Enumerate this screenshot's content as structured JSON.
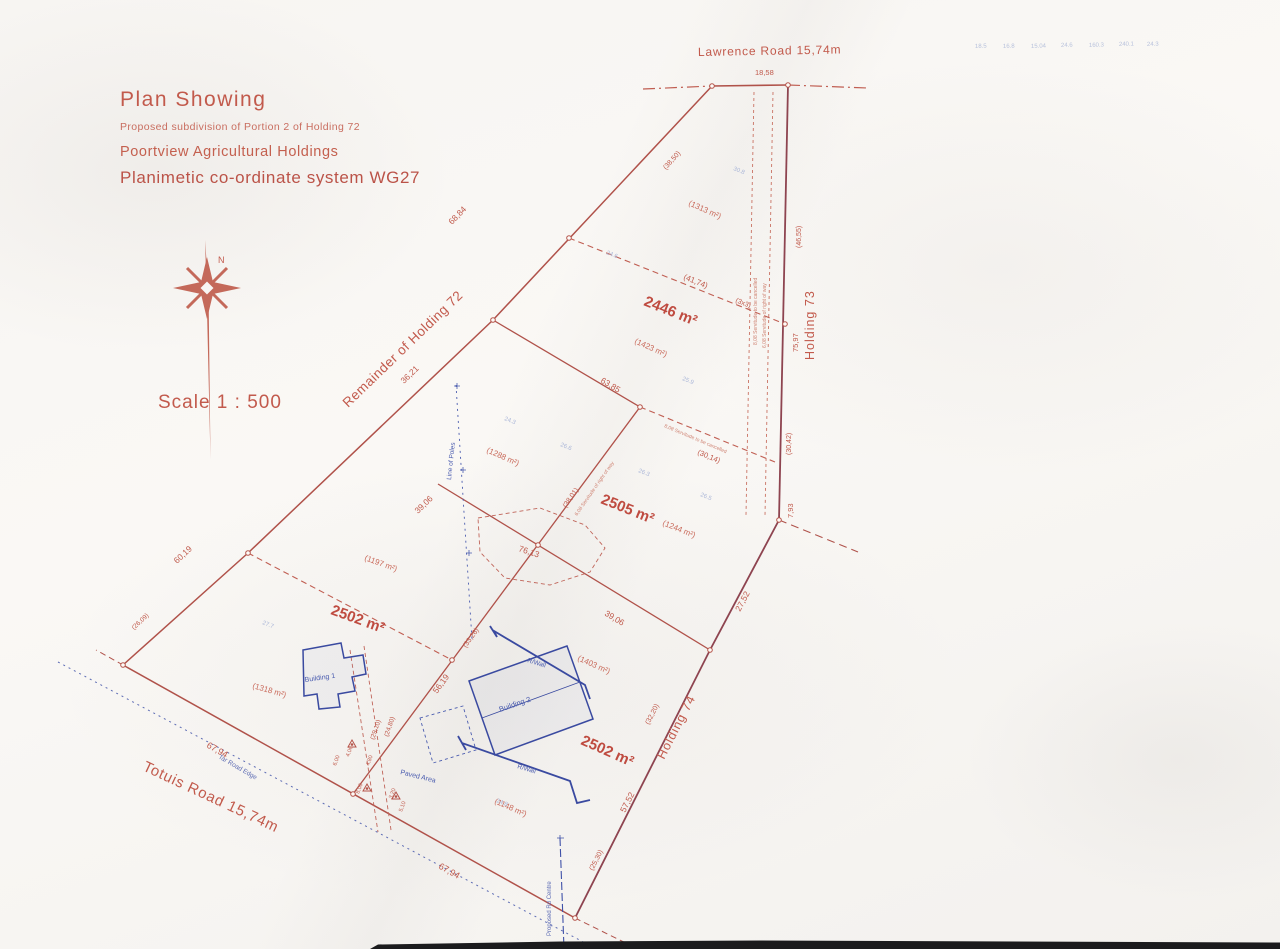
{
  "colors": {
    "plan_red": "#b5544a",
    "boundary_dark": "#8e4450",
    "plan_blue": "#3f51a8",
    "faint_blue": "#aab6d8",
    "paper": "#f7f5f2"
  },
  "title_block": {
    "line1": "Plan Showing",
    "line2": "Proposed subdivision of Portion 2 of Holding 72",
    "line3": "Poortview Agricultural Holdings",
    "line4": "Planimetic co-ordinate system WG27"
  },
  "compass": {
    "north_label": "N"
  },
  "scale_label": "Scale 1 : 500",
  "roads": {
    "lawrence": "Lawrence Road 15,74m",
    "totuis": "Totuis Road 15,74m",
    "tar_edge": "Tar Road Edge",
    "centre_line": "Proposed Rd Centre"
  },
  "holdings": {
    "remainder": "Remainder of Holding 72",
    "h73": "Holding 73",
    "h74": "Holding 74"
  },
  "lot_areas": {
    "top": "2446 m²",
    "middle": "2505 m²",
    "left": "2502 m²",
    "bottom": "2502 m²"
  },
  "sub_areas": {
    "a1313": "(1313 m²)",
    "a1423": "(1423 m²)",
    "a1288": "(1288 m²)",
    "a1244": "(1244 m²)",
    "a1197": "(1197 m²)",
    "a1318": "(1318 m²)",
    "a1403": "(1403 m²)",
    "a1148": "(1148 m²)"
  },
  "dimensions": {
    "d18_58": "18,58",
    "d38_50": "(38,50)",
    "d41_74": "(41,74)",
    "d3x3": "(3x3)",
    "d46_55": "(46,55)",
    "d75_97": "75,97",
    "d30_42": "(30,42)",
    "d7_93": "7,93",
    "d68_84": "68,84",
    "d36_21": "36,21",
    "d63_85": "63,85",
    "d30_14": "(30,14)",
    "d38_01": "(38,01)",
    "d76_13": "76,13",
    "d39_06_a": "39,06",
    "d39_06_b": "39,06",
    "d60_19": "60,19",
    "d26_09": "(26,09)",
    "d27_52": "27,52",
    "d32_20": "(32,20)",
    "d57_52": "57,52",
    "d25_30": "(25,30)",
    "d67_94_a": "67,94",
    "d67_94_b": "67,94",
    "d56_19": "56,19",
    "d33_26": "(33,26)",
    "d29_10": "(29,10)",
    "d24_80": "(24,80)",
    "d4_06": "4,06",
    "d4_80": "4,80",
    "d8_00": "8,00",
    "d3_20": "3,20",
    "d5_10": "5,10",
    "d6_00": "6,00"
  },
  "structures": {
    "building1": "Building 1",
    "building2": "Building 2",
    "paved": "Paved Area",
    "rwall_top": "R/Wall",
    "rwall_bottom": "R/Wall",
    "line_of_poles": "Line of Poles"
  },
  "servitude_notes": {
    "right_a": "8,08 Servitude to be cancelled",
    "right_b": "6,08 Servitude of right of way",
    "diagonal": "8,08 Servitude to be cancelled",
    "west": "6,08 Servitude of right of way"
  },
  "faint_numbers": [
    "18.5",
    "16.8",
    "15.04",
    "24.6",
    "160.3",
    "240.1",
    "24.3"
  ],
  "spot_heights": [
    "30.8",
    "24.3",
    "26.6",
    "26.3",
    "24.6",
    "25.9",
    "27.7",
    "24.8",
    "26.5"
  ]
}
